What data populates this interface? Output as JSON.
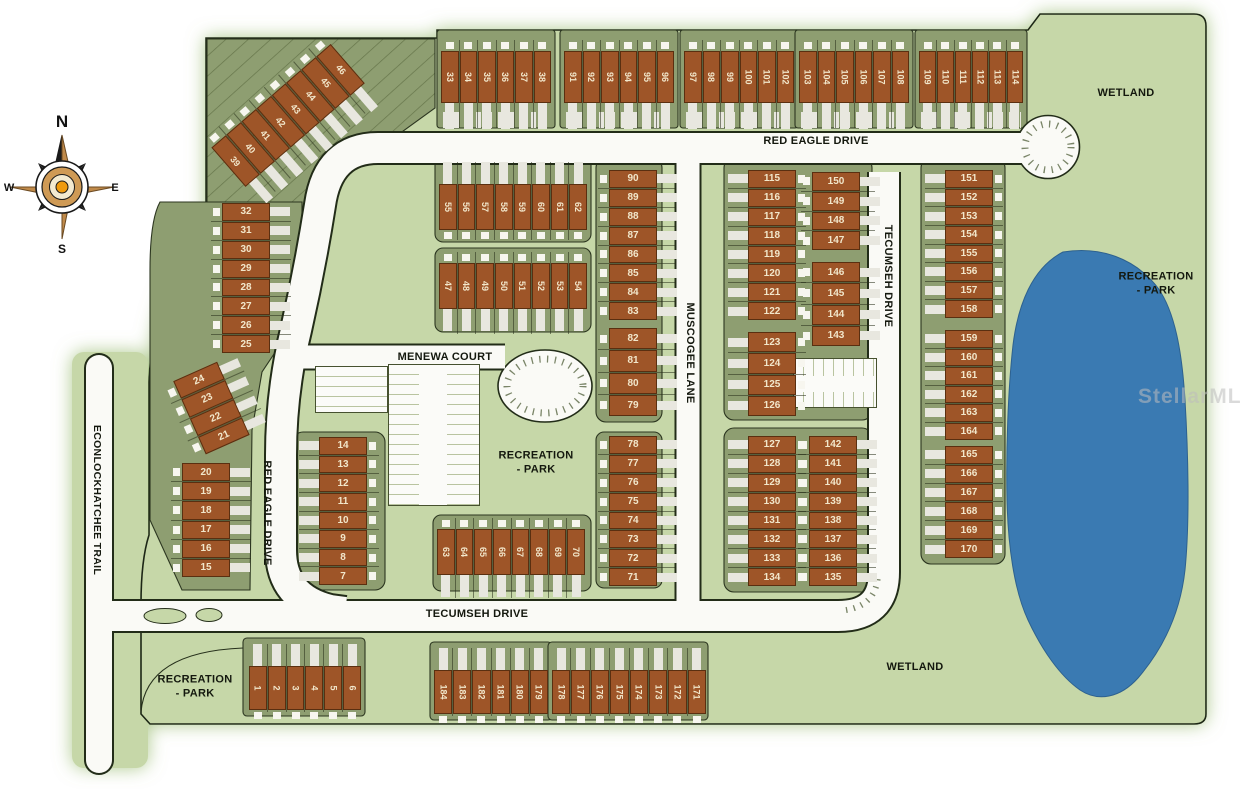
{
  "compass": {
    "north": "N",
    "east": "E",
    "south": "S",
    "west": "W"
  },
  "streets": {
    "red_eagle_top": "RED EAGLE DRIVE",
    "red_eagle_west": "RED EAGLE DRIVE",
    "econlockhatchee": "ECONLOCKHATCHEE TRAIL",
    "muscogee": "MUSCOGEE LANE",
    "tecumseh_bottom": "TECUMSEH DRIVE",
    "tecumseh_east": "TECUMSEH DRIVE",
    "menewa": "MENEWA COURT"
  },
  "areas": {
    "wetland_top": "WETLAND",
    "wetland_bottom": "WETLAND",
    "rec_center_l1": "RECREATION",
    "rec_center_l2": "- PARK",
    "rec_right_l1": "RECREATION",
    "rec_right_l2": "- PARK",
    "rec_bottomleft_l1": "RECREATION",
    "rec_bottomleft_l2": "- PARK"
  },
  "watermark": "StellarMLS",
  "colors": {
    "site_green": "#c6d7a8",
    "parcel_olive": "#8e9e71",
    "lot_brown": "#9e5528",
    "pond_blue": "#3a7ab2",
    "road_white": "#fafaf6"
  },
  "lot_groups": {
    "g39_46": [
      39,
      40,
      41,
      42,
      43,
      44,
      45,
      46
    ],
    "g33_38": [
      33,
      34,
      35,
      36,
      37,
      38
    ],
    "g91_96": [
      91,
      92,
      93,
      94,
      95,
      96
    ],
    "g97_102": [
      97,
      98,
      99,
      100,
      101,
      102
    ],
    "g103_108": [
      103,
      104,
      105,
      106,
      107,
      108
    ],
    "g109_114": [
      109,
      110,
      111,
      112,
      113,
      114
    ],
    "g55_62": [
      55,
      56,
      57,
      58,
      59,
      60,
      61,
      62
    ],
    "g47_54": [
      47,
      48,
      49,
      50,
      51,
      52,
      53,
      54
    ],
    "g25_32": [
      32,
      31,
      30,
      29,
      28,
      27,
      26,
      25
    ],
    "g21_24": [
      24,
      23,
      22,
      21
    ],
    "g15_20": [
      20,
      19,
      18,
      17,
      16,
      15
    ],
    "g7_14": [
      14,
      13,
      12,
      11,
      10,
      9,
      8,
      7
    ],
    "g83_90": [
      90,
      89,
      88,
      87,
      86,
      85,
      84,
      83
    ],
    "g79_82": [
      82,
      81,
      80,
      79
    ],
    "g115_122": [
      115,
      116,
      117,
      118,
      119,
      120,
      121,
      122
    ],
    "g150_147": [
      150,
      149,
      148,
      147
    ],
    "g146_143": [
      146,
      145,
      144,
      143
    ],
    "g123_126": [
      123,
      124,
      125,
      126
    ],
    "g127_134": [
      127,
      128,
      129,
      130,
      131,
      132,
      133,
      134
    ],
    "g142_135": [
      142,
      141,
      140,
      139,
      138,
      137,
      136,
      135
    ],
    "g151_158": [
      151,
      152,
      153,
      154,
      155,
      156,
      157,
      158
    ],
    "g159_164": [
      159,
      160,
      161,
      162,
      163,
      164
    ],
    "g165_170": [
      165,
      166,
      167,
      168,
      169,
      170
    ],
    "g63_70": [
      63,
      64,
      65,
      66,
      67,
      68,
      69,
      70
    ],
    "g71_78": [
      78,
      77,
      76,
      75,
      74,
      73,
      72,
      71
    ],
    "g1_6": [
      1,
      2,
      3,
      4,
      5,
      6
    ],
    "g184_179": [
      184,
      183,
      182,
      181,
      180,
      179
    ],
    "g178_171": [
      178,
      177,
      176,
      175,
      174,
      173,
      172,
      171
    ]
  }
}
